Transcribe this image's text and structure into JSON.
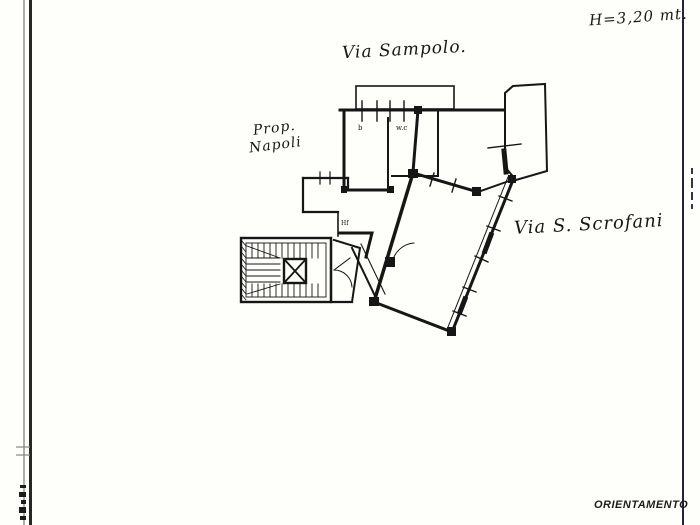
{
  "annotations": {
    "street_top": "Via Sampolo.",
    "height_note": "H=3,20 mt.",
    "owner_line1": "Prop.",
    "owner_line2": "Napoli",
    "street_right": "Via S. Scrofani",
    "orientation_label": "ORIENTAMENTO"
  },
  "plan_labels": {
    "room_b": "b",
    "room_wc": "w.c",
    "corridor_mark": "Hf"
  },
  "colors": {
    "ink": "#161616",
    "scan_gray_line": "#adadad",
    "sheet_edge_black": "#262626",
    "right_edge_line": "#23233a",
    "paper": "#fefefb"
  }
}
